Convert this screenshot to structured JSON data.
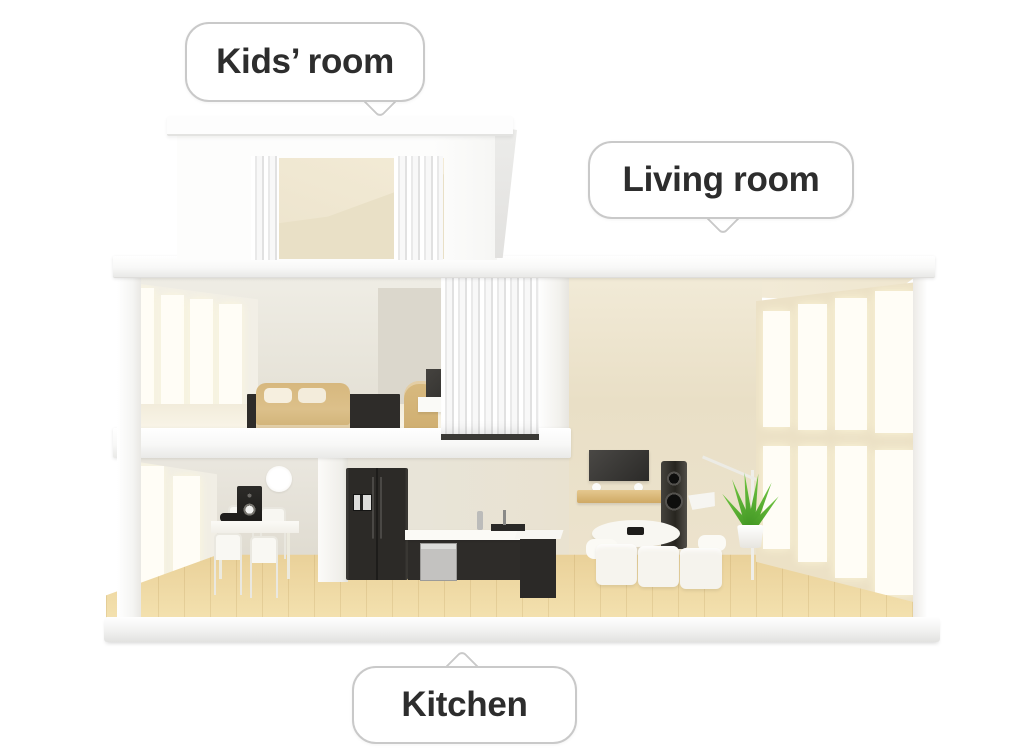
{
  "illustration": {
    "description": "3D cutaway dollhouse view of a two-storey home with labelled rooms",
    "background": "#ffffff"
  },
  "callouts": {
    "kids_room": {
      "label": "Kids’ room",
      "tail_direction": "down"
    },
    "living_room": {
      "label": "Living room",
      "tail_direction": "down"
    },
    "kitchen": {
      "label": "Kitchen",
      "tail_direction": "up"
    }
  },
  "palette": {
    "bubble_border": "#c9c9c9",
    "bubble_background": "#ffffff",
    "bubble_text": "#2d2d2d",
    "structure_white": "#fafafa",
    "interior_beige": "#e9dfc6",
    "interior_gray": "#e5e1d6",
    "wood_floor": "#eed7a2",
    "dark_furniture": "#2e2c29",
    "sofa_tan": "#dabd84",
    "stainless": "#c9c8c6",
    "plant_green": "#55a82f"
  }
}
